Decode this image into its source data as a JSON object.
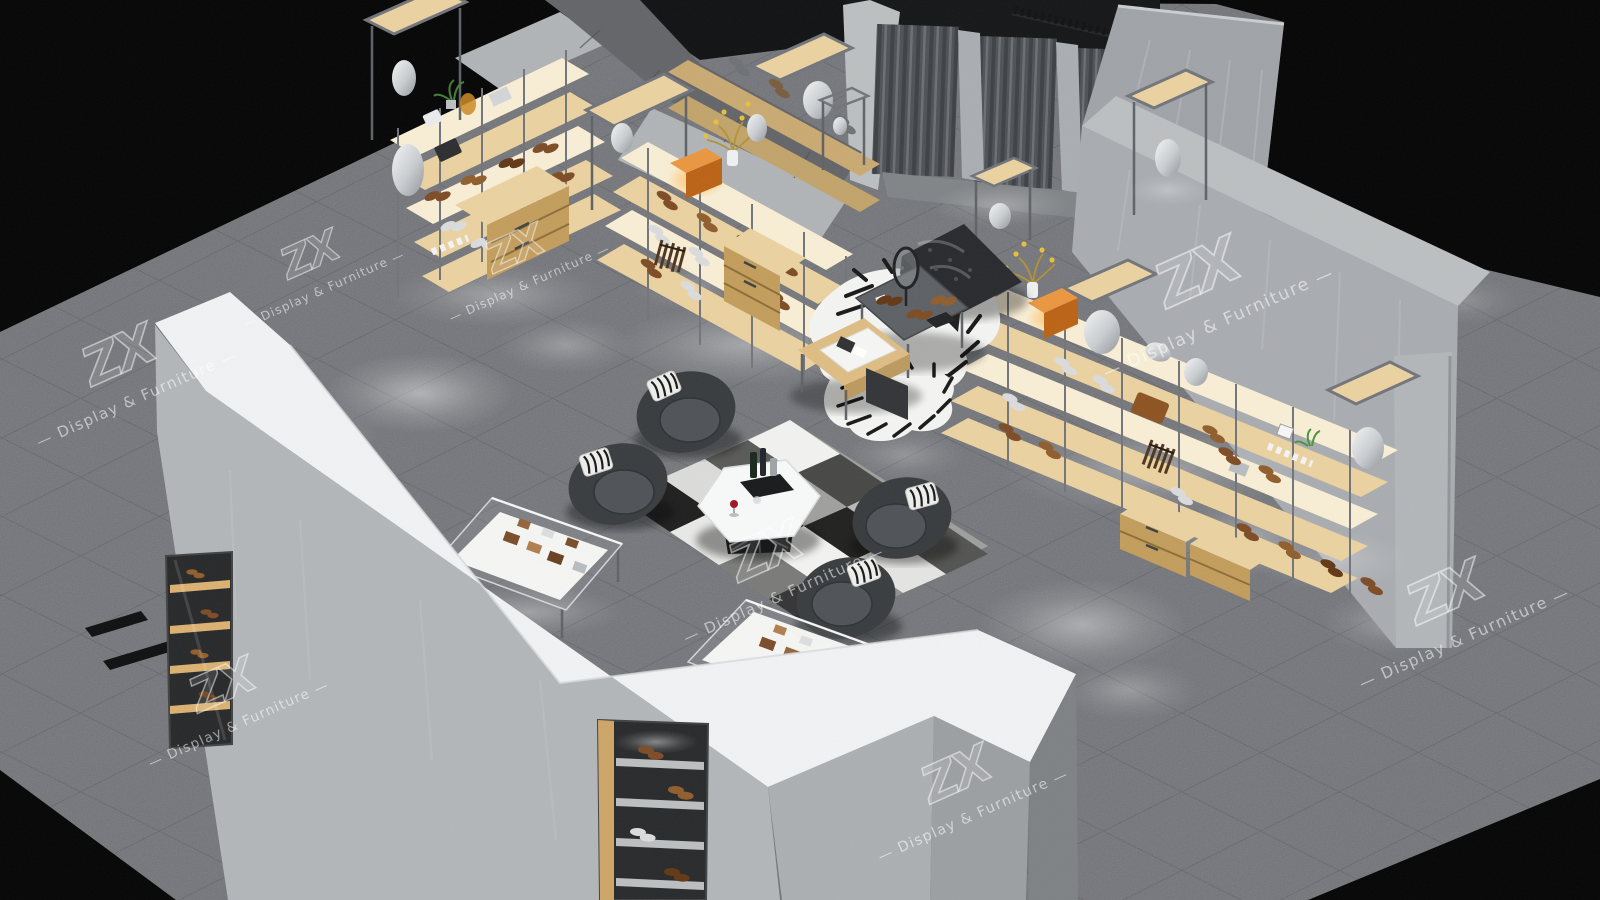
{
  "scene": {
    "description": "Aerial 3D rendering of a grey concrete luxury shoe and leather-goods showroom with wood and steel display shelving, fitting rooms with curtains, lounge seating, zebra rugs and glass display cases, viewed isometrically on a black background",
    "background": "#000000",
    "render_style": "isometric 3D store visualization"
  },
  "watermark": {
    "brand": "ZX",
    "label": "— Display & Furniture —",
    "color": "#ffffff",
    "opacity": 0.3,
    "instances": 8
  },
  "palette": {
    "background": "#000000",
    "floor_tile": "#67696e",
    "tile_grout": "#4d5053",
    "concrete_wall": "#a7abaf",
    "concrete_top": "#b9bcbe",
    "white_counter": "#eef0f2",
    "wood_shelf": "#e8cf9d",
    "wood_drawer": "#c09a58",
    "steel_frame": "#6e7177",
    "curtain_grey": "#55585c",
    "armchair_charcoal": "#34373a",
    "leather_brown": "#7a4822",
    "illuminated_amber": "#e8933c",
    "zebra_white": "#f2f2f0",
    "zebra_black": "#141414",
    "wine_red": "#9c1020"
  },
  "objects": [
    "grey tiled showroom floor",
    "L-shaped wood and steel wall shelving with shoes, bags and vases",
    "illuminated amber display boxes",
    "fitting rooms with grey curtains",
    "rail of black clothes hangers",
    "long wall shelving unit with sneakers, loafers, belts and backpacks",
    "wooden drawer cabinets",
    "cashier desk with tablet and tray",
    "zebra hide rugs",
    "black tufted leather bench",
    "display table with dress shoes and round mirror",
    "four charcoal lounge armchairs with zebra cushions",
    "white hexagonal coffee table with decanters and red wine",
    "black and white patchwork rug",
    "two glass display cases with leather wallets",
    "chevron storefront wall with white counter top and lit shoe niches",
    "concrete entrance pillar",
    "ZX Display and Furniture watermarks"
  ]
}
